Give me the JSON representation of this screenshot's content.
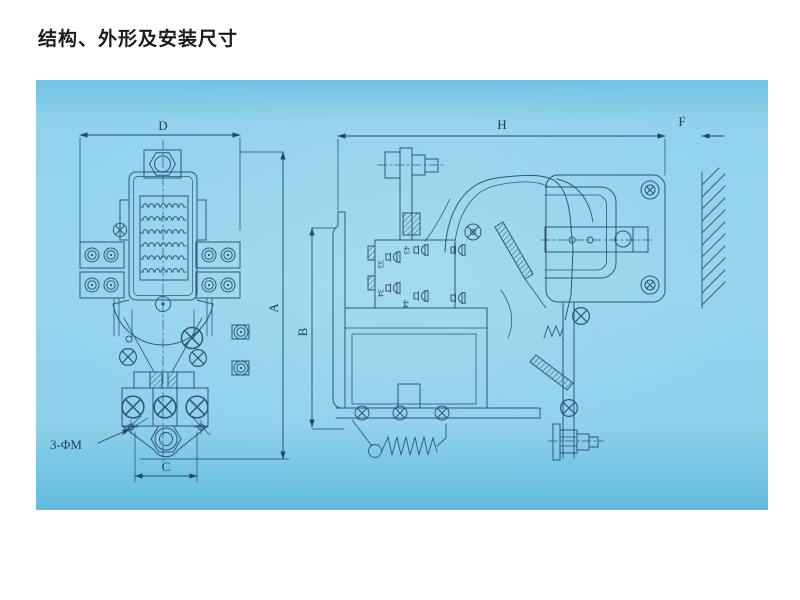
{
  "page": {
    "title": "结构、外形及安装尺寸"
  },
  "drawing": {
    "dimensions": {
      "d": "D",
      "a": "A",
      "b": "B",
      "c": "C",
      "h": "H",
      "f": "F",
      "mounting_holes": "3-ΦM"
    },
    "terminals": {
      "t43": "43",
      "t33": "33",
      "t34": "34",
      "t44": "44"
    },
    "colors": {
      "panel_background": "#8dd0ea",
      "line": "#2f567a",
      "title_text": "#1a1a1a"
    }
  }
}
